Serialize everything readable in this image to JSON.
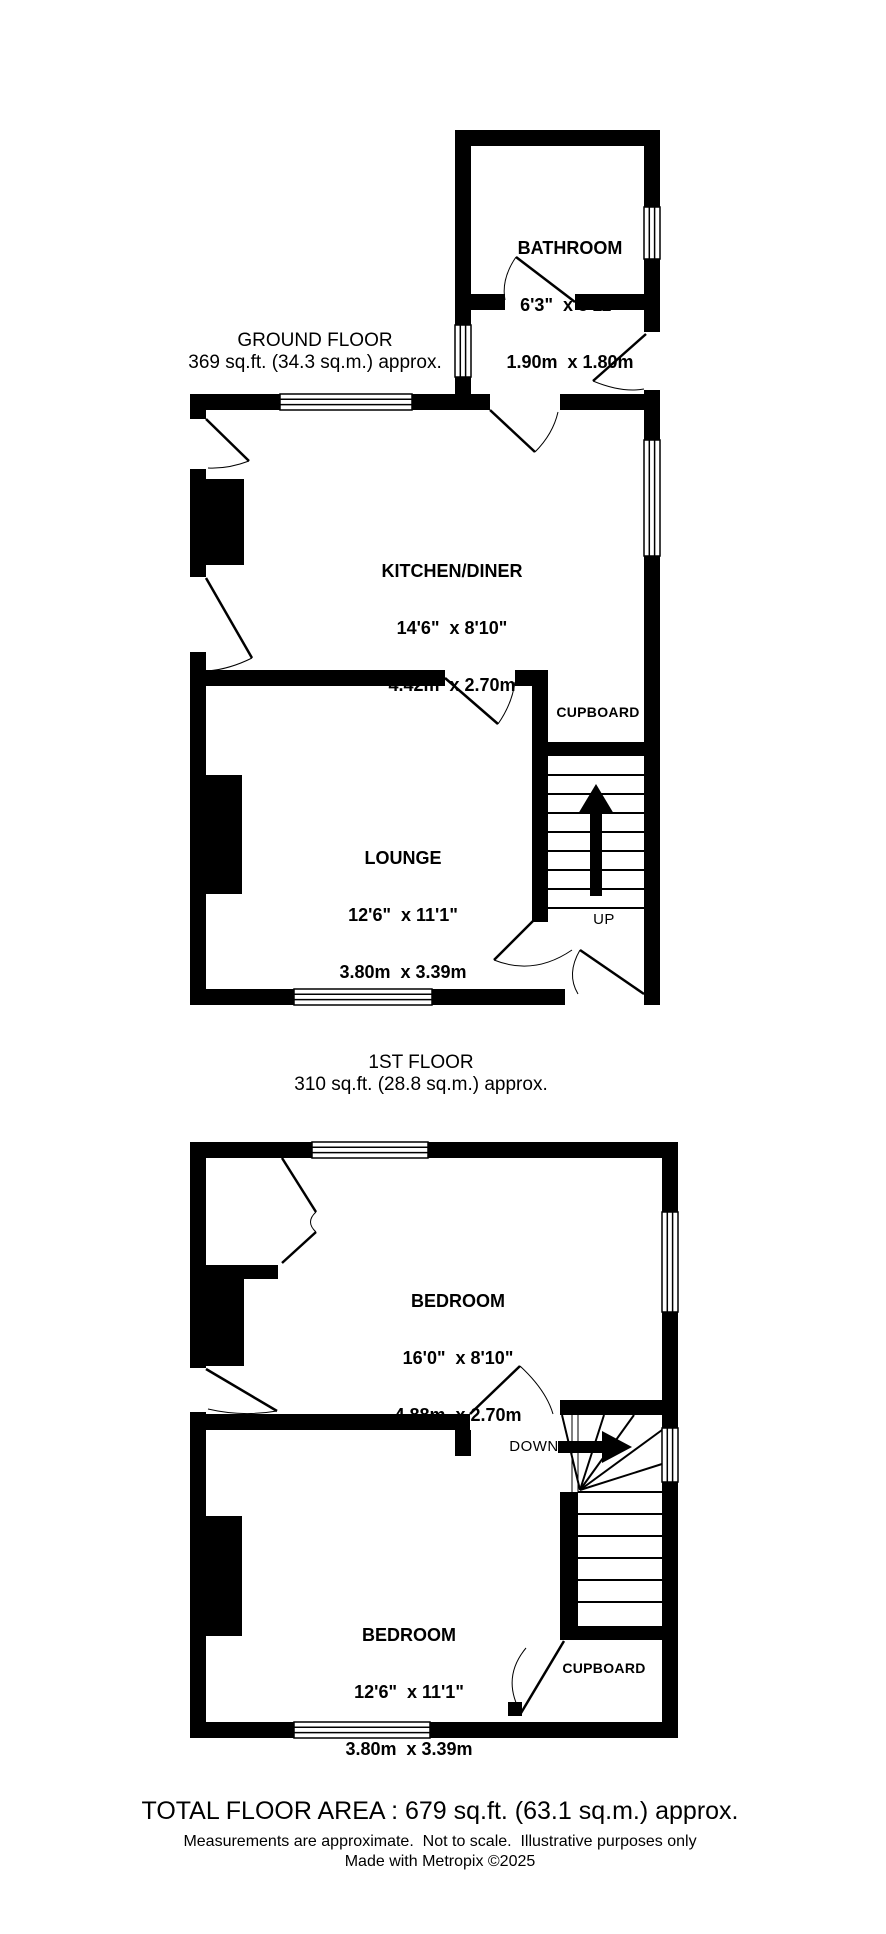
{
  "colors": {
    "background": "#ffffff",
    "ink": "#000000"
  },
  "ground_floor": {
    "title": "GROUND FLOOR",
    "area": "369 sq.ft. (34.3 sq.m.) approx.",
    "bathroom": {
      "name": "BATHROOM",
      "imperial": "6'3\"  x 5'11\"",
      "metric": "1.90m  x 1.80m"
    },
    "kitchen_diner": {
      "name": "KITCHEN/DINER",
      "imperial": "14'6\"  x 8'10\"",
      "metric": "4.42m  x 2.70m"
    },
    "lounge": {
      "name": "LOUNGE",
      "imperial": "12'6\"  x 11'1\"",
      "metric": "3.80m  x 3.39m"
    },
    "cupboard": {
      "name": "CUPBOARD"
    },
    "stair_direction": "UP"
  },
  "first_floor": {
    "title": "1ST FLOOR",
    "area": "310 sq.ft. (28.8 sq.m.) approx.",
    "bedroom_front": {
      "name": "BEDROOM",
      "imperial": "16'0\"  x 8'10\"",
      "metric": "4.88m  x 2.70m"
    },
    "bedroom_back": {
      "name": "BEDROOM",
      "imperial": "12'6\"  x 11'1\"",
      "metric": "3.80m  x 3.39m"
    },
    "cupboard": {
      "name": "CUPBOARD"
    },
    "stair_direction": "DOWN"
  },
  "footer": {
    "total_area": "TOTAL FLOOR AREA : 679 sq.ft. (63.1 sq.m.) approx.",
    "disclaimer": "Measurements are approximate.  Not to scale.  Illustrative purposes only",
    "credit": "Made with Metropix ©2025"
  }
}
